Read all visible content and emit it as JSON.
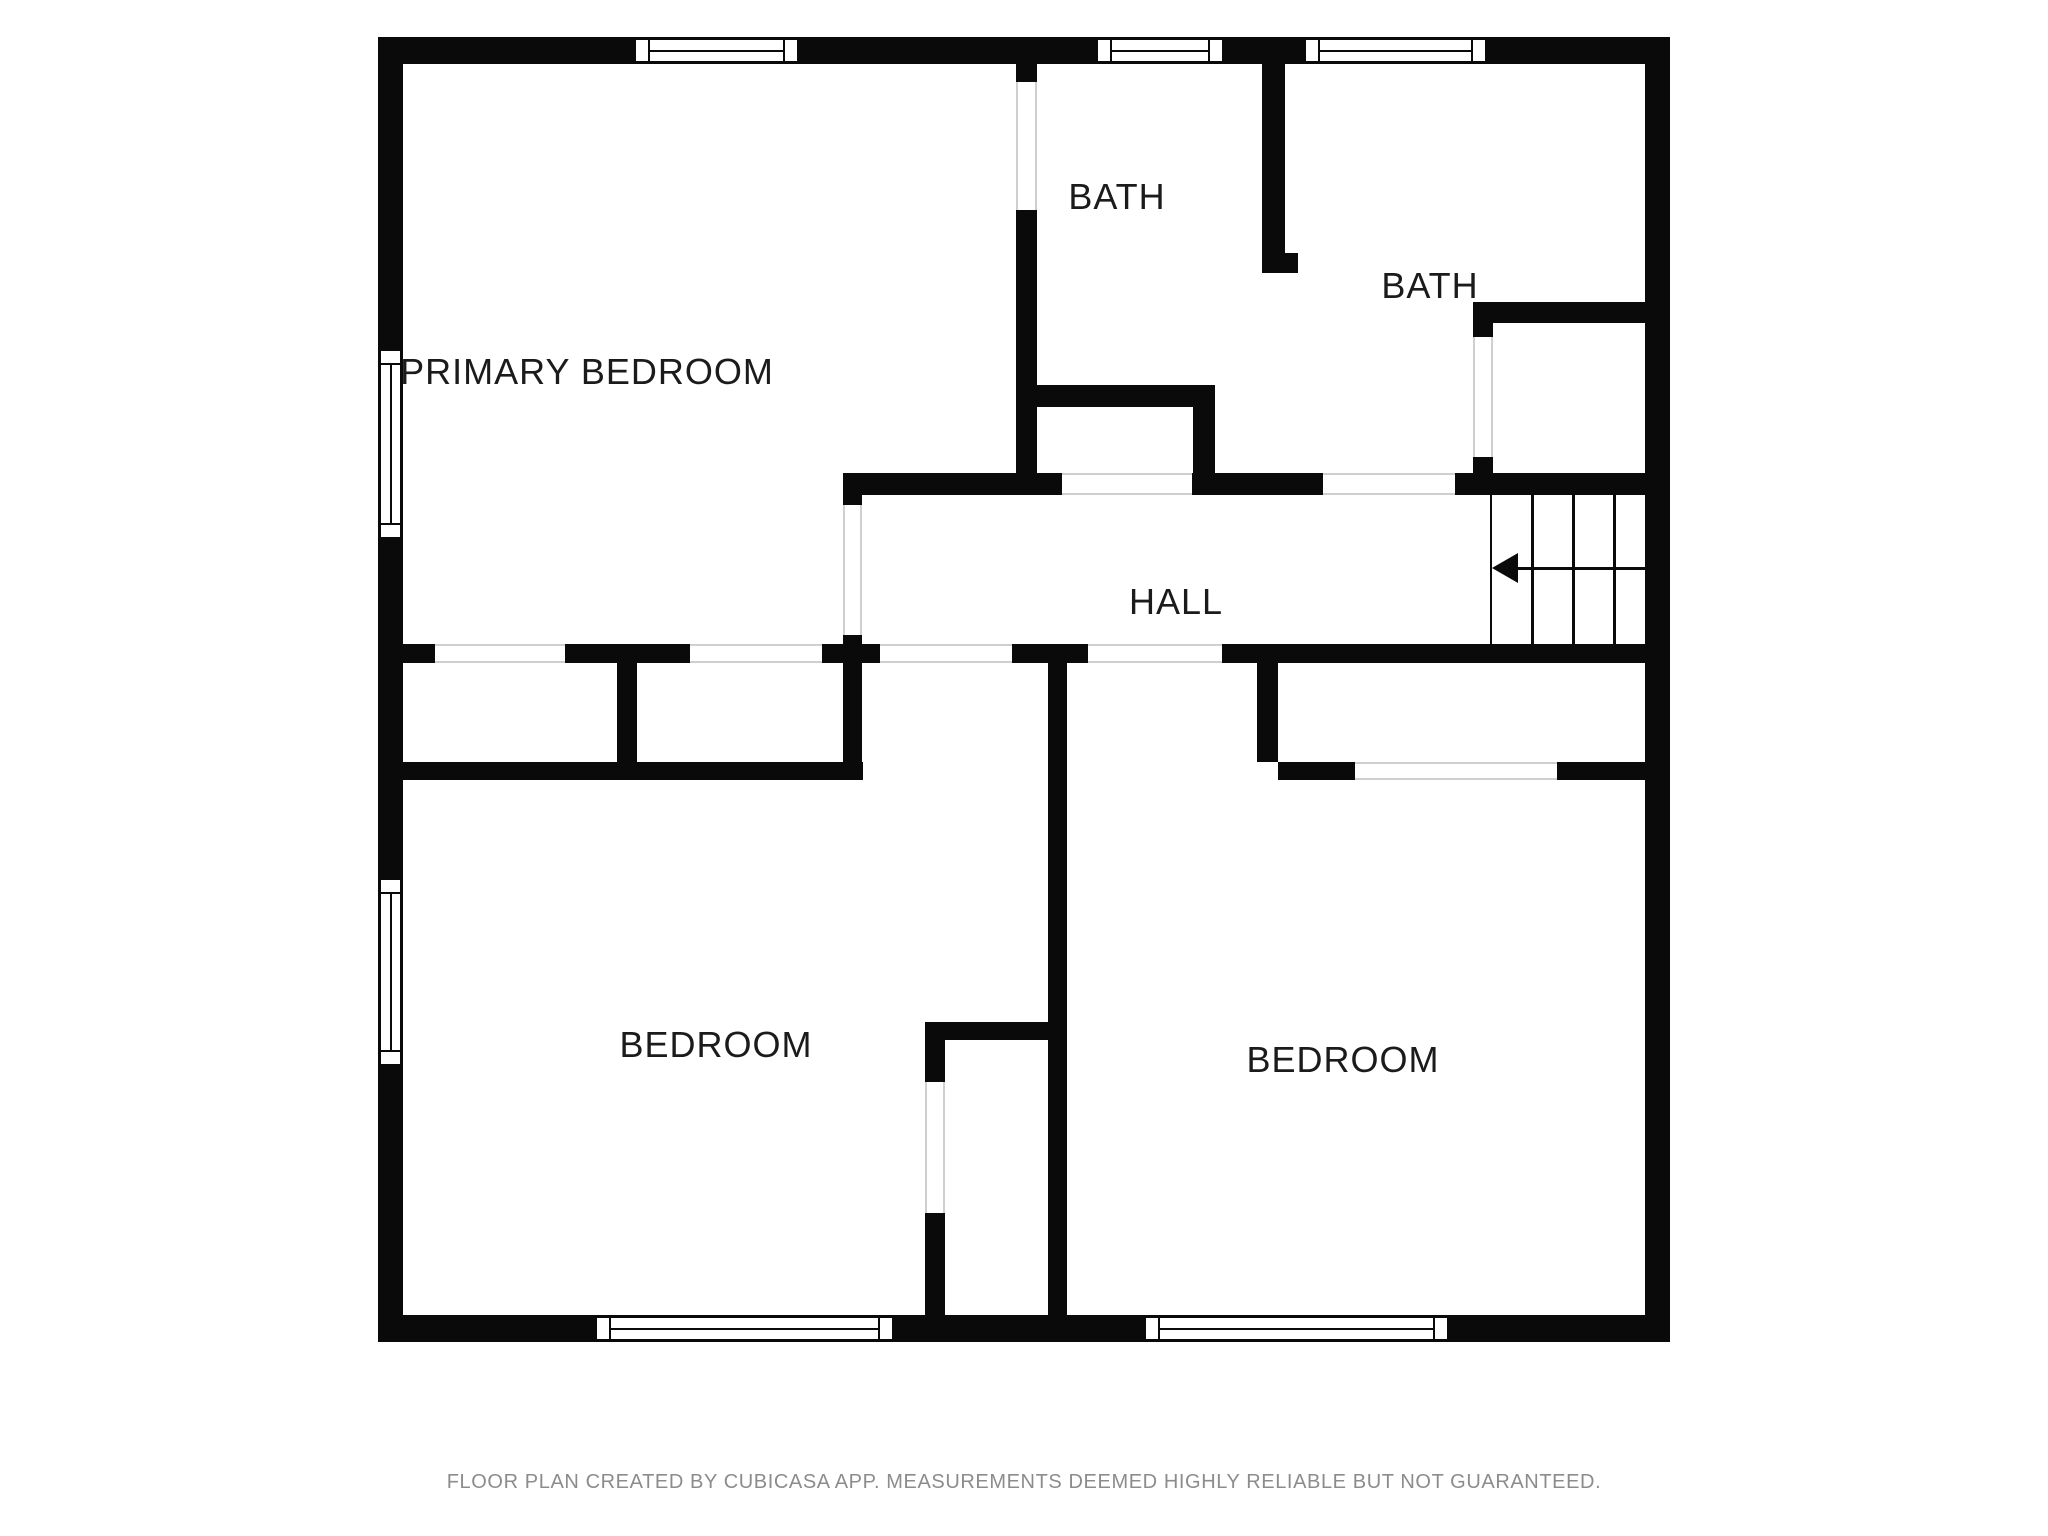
{
  "floor_plan": {
    "wall_color": "#0a0a0a",
    "label_color": "#1b1b1b",
    "opening_line_color": "#cfcfcf",
    "rooms": [
      {
        "id": "primary-bedroom",
        "label": "PRIMARY BEDROOM",
        "cx": 587,
        "cy": 372
      },
      {
        "id": "bath-1",
        "label": "BATH",
        "cx": 1117,
        "cy": 197
      },
      {
        "id": "bath-2",
        "label": "BATH",
        "cx": 1430,
        "cy": 286
      },
      {
        "id": "hall",
        "label": "HALL",
        "cx": 1176,
        "cy": 602
      },
      {
        "id": "bedroom-left",
        "label": "BEDROOM",
        "cx": 716,
        "cy": 1045
      },
      {
        "id": "bedroom-right",
        "label": "BEDROOM",
        "cx": 1343,
        "cy": 1060
      }
    ],
    "walls": [
      {
        "x": 378,
        "y": 37,
        "w": 255,
        "h": 27
      },
      {
        "x": 800,
        "y": 37,
        "w": 295,
        "h": 27
      },
      {
        "x": 1225,
        "y": 37,
        "w": 78,
        "h": 27
      },
      {
        "x": 1488,
        "y": 37,
        "w": 182,
        "h": 27
      },
      {
        "x": 378,
        "y": 1315,
        "w": 216,
        "h": 27
      },
      {
        "x": 895,
        "y": 1315,
        "w": 248,
        "h": 27
      },
      {
        "x": 1450,
        "y": 1315,
        "w": 218,
        "h": 27
      },
      {
        "x": 378,
        "y": 37,
        "w": 25,
        "h": 311
      },
      {
        "x": 378,
        "y": 540,
        "w": 25,
        "h": 337
      },
      {
        "x": 378,
        "y": 1067,
        "w": 25,
        "h": 275
      },
      {
        "x": 1645,
        "y": 37,
        "w": 25,
        "h": 1305
      },
      {
        "x": 1016,
        "y": 64,
        "w": 21,
        "h": 18
      },
      {
        "x": 1016,
        "y": 210,
        "w": 21,
        "h": 267
      },
      {
        "x": 843,
        "y": 473,
        "w": 219,
        "h": 22
      },
      {
        "x": 843,
        "y": 473,
        "w": 19,
        "h": 32
      },
      {
        "x": 843,
        "y": 635,
        "w": 19,
        "h": 145
      },
      {
        "x": 403,
        "y": 644,
        "w": 32,
        "h": 19
      },
      {
        "x": 565,
        "y": 644,
        "w": 125,
        "h": 19
      },
      {
        "x": 822,
        "y": 644,
        "w": 58,
        "h": 19
      },
      {
        "x": 1012,
        "y": 644,
        "w": 76,
        "h": 19
      },
      {
        "x": 1222,
        "y": 644,
        "w": 423,
        "h": 19
      },
      {
        "x": 617,
        "y": 663,
        "w": 20,
        "h": 99
      },
      {
        "x": 403,
        "y": 762,
        "w": 460,
        "h": 18
      },
      {
        "x": 1035,
        "y": 385,
        "w": 180,
        "h": 22
      },
      {
        "x": 1193,
        "y": 407,
        "w": 22,
        "h": 68
      },
      {
        "x": 1192,
        "y": 473,
        "w": 131,
        "h": 22
      },
      {
        "x": 1262,
        "y": 64,
        "w": 23,
        "h": 209
      },
      {
        "x": 1262,
        "y": 253,
        "w": 36,
        "h": 20
      },
      {
        "x": 1473,
        "y": 302,
        "w": 172,
        "h": 21
      },
      {
        "x": 1473,
        "y": 323,
        "w": 20,
        "h": 14
      },
      {
        "x": 1473,
        "y": 457,
        "w": 20,
        "h": 16
      },
      {
        "x": 1455,
        "y": 473,
        "w": 190,
        "h": 22
      },
      {
        "x": 1048,
        "y": 663,
        "w": 19,
        "h": 654
      },
      {
        "x": 1257,
        "y": 663,
        "w": 21,
        "h": 99
      },
      {
        "x": 1278,
        "y": 762,
        "w": 77,
        "h": 18
      },
      {
        "x": 1557,
        "y": 762,
        "w": 88,
        "h": 18
      },
      {
        "x": 925,
        "y": 1022,
        "w": 142,
        "h": 18
      },
      {
        "x": 925,
        "y": 1022,
        "w": 20,
        "h": 60
      },
      {
        "x": 925,
        "y": 1213,
        "w": 20,
        "h": 104
      }
    ],
    "openings": [
      {
        "x": 1016,
        "y": 82,
        "w": 21,
        "h": 128,
        "o": "v"
      },
      {
        "x": 843,
        "y": 505,
        "w": 19,
        "h": 130,
        "o": "v"
      },
      {
        "x": 435,
        "y": 644,
        "w": 130,
        "h": 19,
        "o": "h"
      },
      {
        "x": 690,
        "y": 644,
        "w": 132,
        "h": 19,
        "o": "h"
      },
      {
        "x": 880,
        "y": 644,
        "w": 132,
        "h": 19,
        "o": "h"
      },
      {
        "x": 1088,
        "y": 644,
        "w": 134,
        "h": 19,
        "o": "h"
      },
      {
        "x": 1062,
        "y": 473,
        "w": 130,
        "h": 22,
        "o": "h"
      },
      {
        "x": 1323,
        "y": 473,
        "w": 132,
        "h": 22,
        "o": "h"
      },
      {
        "x": 1473,
        "y": 337,
        "w": 20,
        "h": 120,
        "o": "v"
      },
      {
        "x": 1355,
        "y": 762,
        "w": 202,
        "h": 18,
        "o": "h"
      },
      {
        "x": 925,
        "y": 1082,
        "w": 20,
        "h": 131,
        "o": "v"
      }
    ],
    "windows": [
      {
        "x": 633,
        "y": 37,
        "w": 167,
        "h": 27,
        "o": "h"
      },
      {
        "x": 1095,
        "y": 37,
        "w": 130,
        "h": 27,
        "o": "h"
      },
      {
        "x": 1303,
        "y": 37,
        "w": 185,
        "h": 27,
        "o": "h"
      },
      {
        "x": 594,
        "y": 1315,
        "w": 301,
        "h": 27,
        "o": "h"
      },
      {
        "x": 1143,
        "y": 1315,
        "w": 307,
        "h": 27,
        "o": "h"
      },
      {
        "x": 378,
        "y": 348,
        "w": 25,
        "h": 192,
        "o": "v"
      },
      {
        "x": 378,
        "y": 877,
        "w": 25,
        "h": 190,
        "o": "v"
      }
    ],
    "stairs": {
      "x": 1490,
      "y": 495,
      "w": 155,
      "h": 149,
      "treads_x": [
        1531,
        1572,
        1613
      ],
      "direction_line_y": 568,
      "arrow_direction": "left"
    },
    "footer": "FLOOR PLAN CREATED BY CUBICASA APP. MEASUREMENTS DEEMED HIGHLY RELIABLE BUT NOT GUARANTEED."
  }
}
